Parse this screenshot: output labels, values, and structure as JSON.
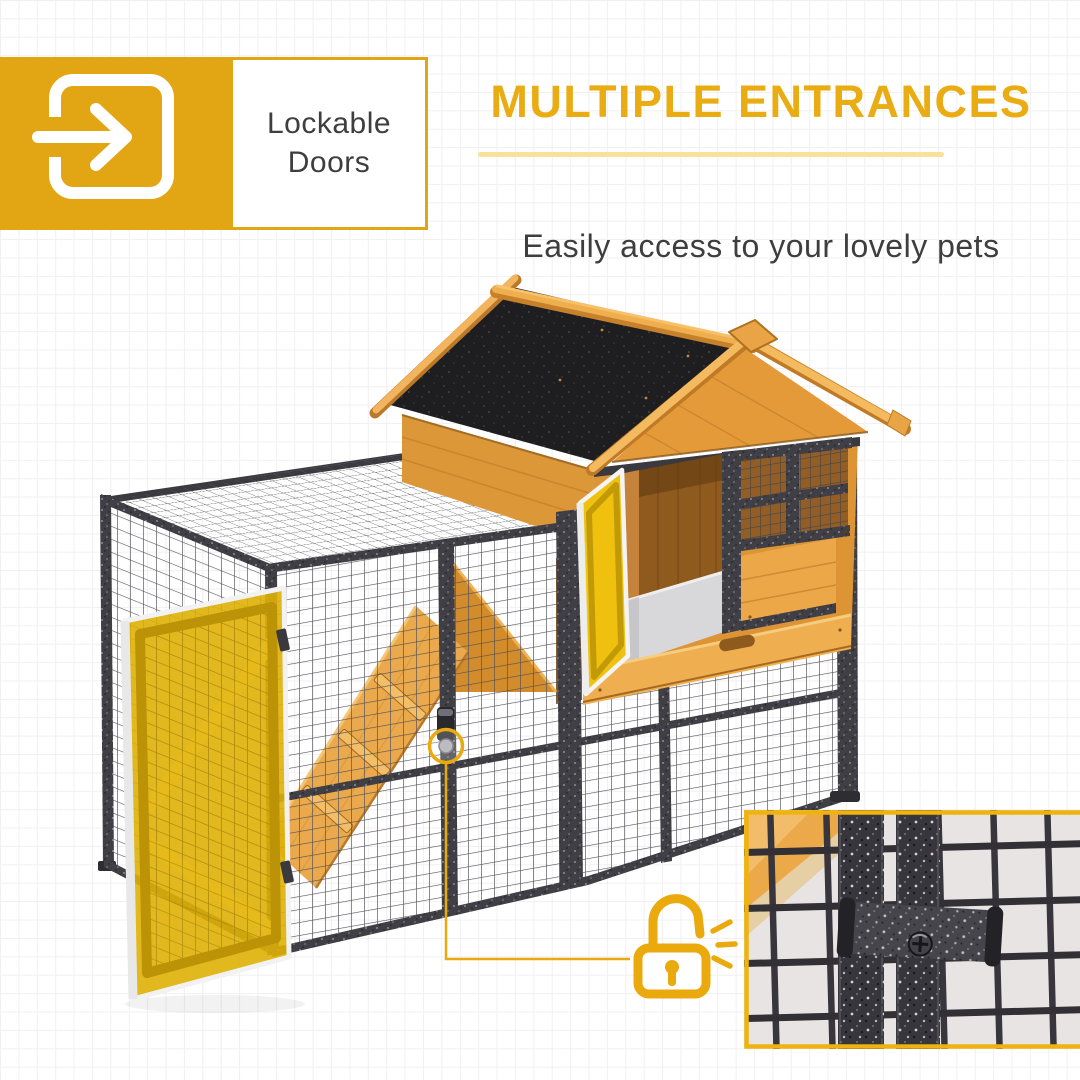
{
  "badge": {
    "icon": "door-enter-icon",
    "label_line1": "Lockable",
    "label_line2": "Doors"
  },
  "headline": {
    "title": "MULTIPLE ENTRANCES",
    "subtitle": "Easily access to your lovely pets"
  },
  "callout": {
    "icon": "open-padlock-icon"
  },
  "scene": {
    "subject": "Wooden pet hutch with black asphalt gable roof, wire mesh run, climbing ramp, two open doors highlighted in yellow, latch callout and close-up inset of the metal door latch"
  },
  "colors": {
    "accent": "#E9AA0E",
    "badge_yellow": "#E2A513",
    "heading_yellow": "#E9AC12",
    "underline_yellow": "#F8E29B",
    "text_dark": "#3E3E3E",
    "door_highlight": "#EFC30D",
    "wood": "#E49A3E",
    "roof_black": "#1E1E20",
    "metal": "#3E3D43",
    "background_grid": "#F2EFEF"
  }
}
